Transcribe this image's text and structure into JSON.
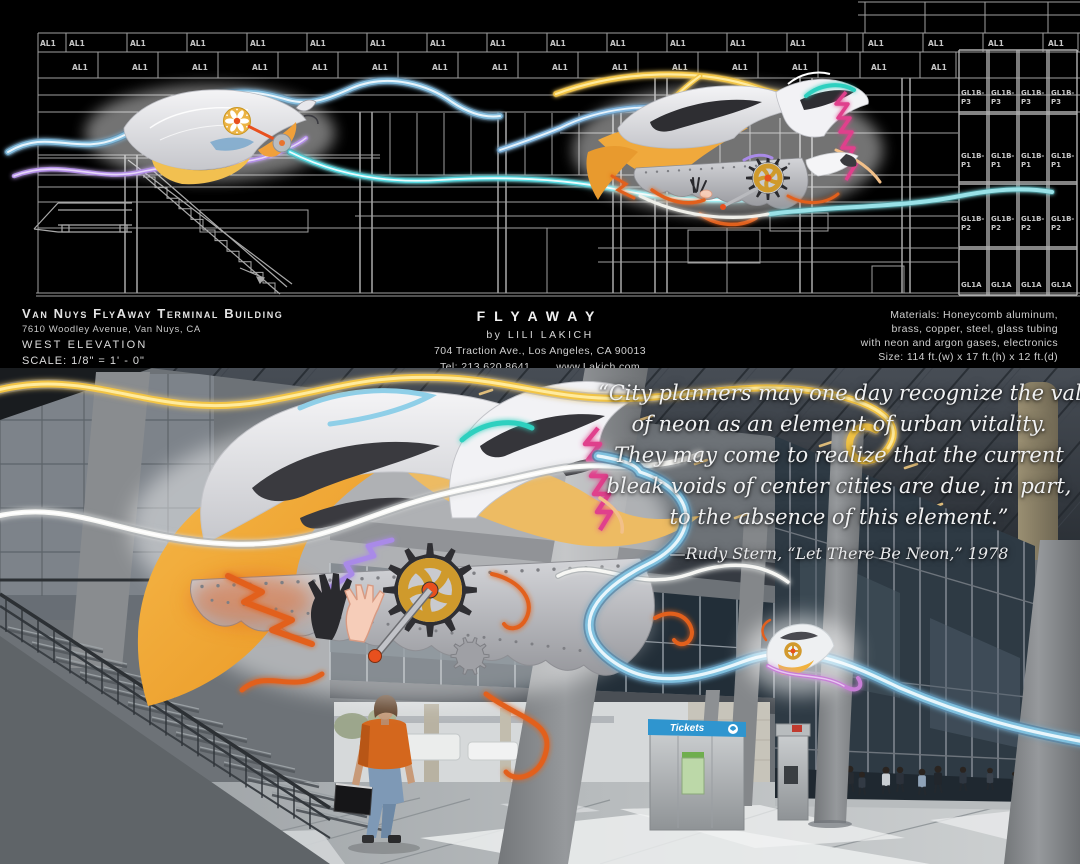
{
  "title_block": {
    "building": "Van Nuys FlyAway Terminal Building",
    "address": "7610 Woodley Avenue, Van Nuys, CA",
    "view": "WEST ELEVATION",
    "scale": "SCALE:  1/8\" = 1' - 0\""
  },
  "artist_block": {
    "title": "FLYAWAY",
    "artist": "by LILI LAKICH",
    "studio": "704 Traction Ave., Los Angeles, CA 90013",
    "tel": "Tel: 213.620.8641",
    "web": "www.Lakich.com"
  },
  "specs_block": {
    "lines": [
      "Materials: Honeycomb aluminum,",
      "brass, copper, steel, glass tubing",
      "with neon and argon gases, electronics",
      "Size: 114 ft.(w) x 17 ft.(h) x 12 ft.(d)"
    ]
  },
  "elevation": {
    "panel_label": "AL1",
    "glass_labels": [
      [
        "GL1B-",
        "P3"
      ],
      [
        "GL1B-",
        "P1"
      ],
      [
        "GL1B-",
        "P2"
      ],
      [
        "GL1A",
        ""
      ]
    ]
  },
  "photo": {
    "quote_lines": [
      "“City planners may one day recognize the value",
      "of neon as an element of urban vitality.",
      "They may come to realize that the current",
      "bleak voids of center cities are due, in part,",
      "to the absence of this element.”"
    ],
    "attribution": "—Rudy Stern, “Let There Be Neon,” 1978",
    "kiosk_label": "Tickets"
  },
  "colors": {
    "neon_yellow": "#f2c445",
    "neon_white": "#f8f8f5",
    "neon_blue": "#7fc0de",
    "neon_cyan": "#54d8e0",
    "neon_purple": "#b490e8",
    "neon_pink": "#e0418c",
    "neon_orange": "#e2601f",
    "gold": "#f0a93c",
    "gear_gold": "#cf9a2c",
    "hub_orange": "#e8501e",
    "kiosk_blue": "#2f95cf"
  }
}
